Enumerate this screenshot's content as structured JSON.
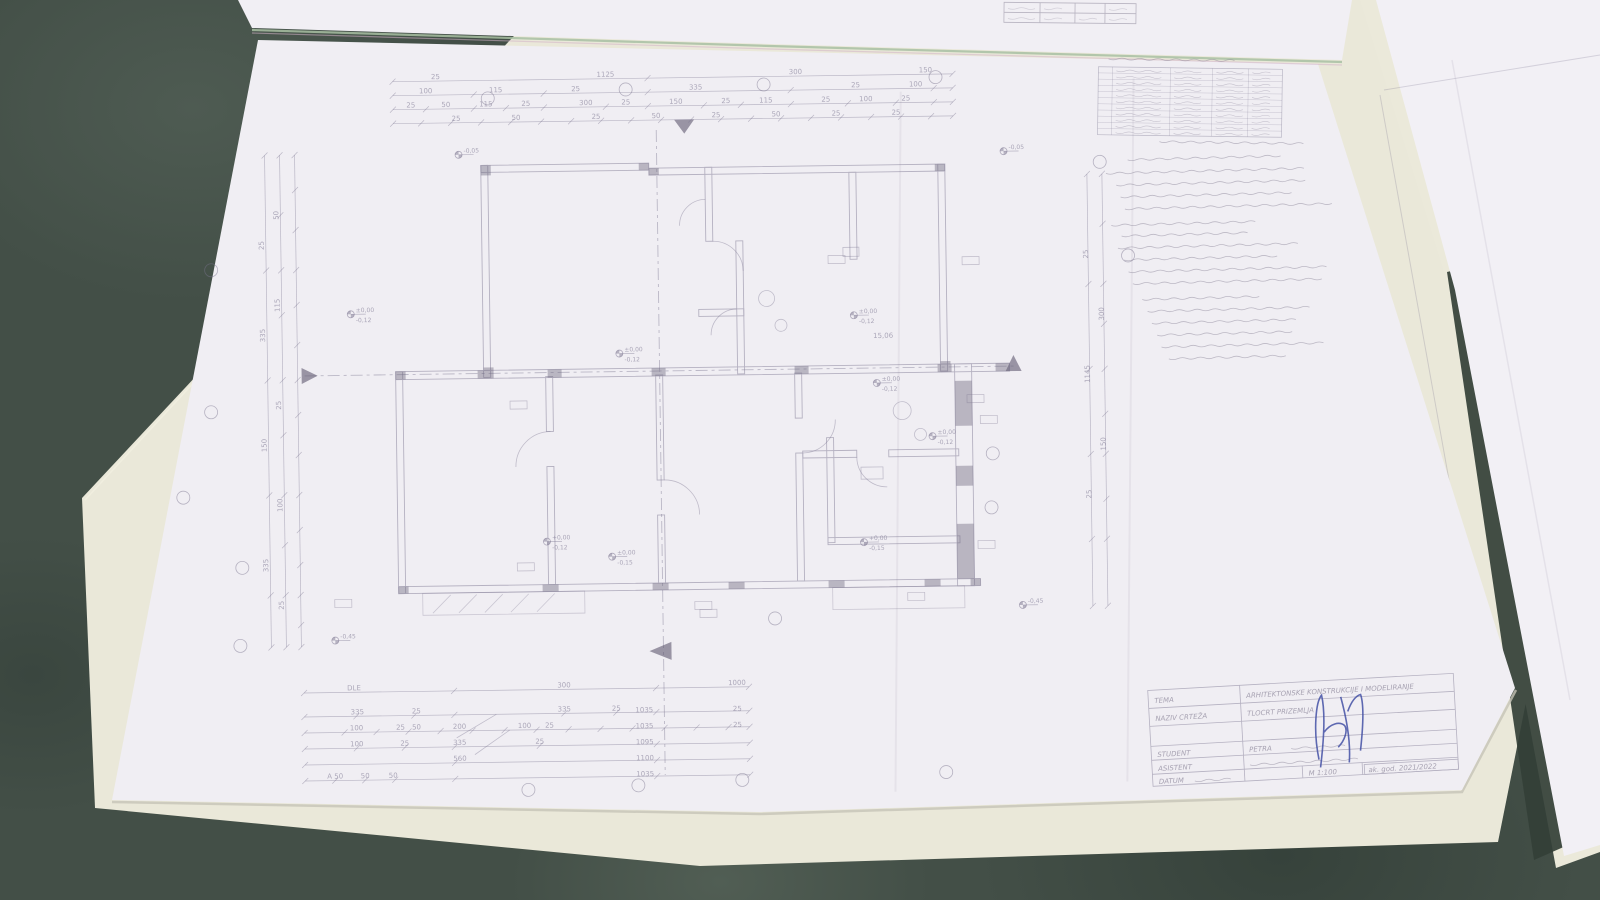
{
  "meta": {
    "description": "Photo of a hand-drawn pencil architectural floor plan sheet on a cream drawing board, dark green table, neighbouring sheets at top and right",
    "pencil_color": "#7b7590",
    "paper_color": "#f0eef3",
    "board_color": "#eae8d9",
    "table_color": "#434f47",
    "signature_color": "#4350a5"
  },
  "title_block": {
    "rows": [
      {
        "label": "TEMA",
        "value": "ARHITEKTONSKE KONSTRUKCIJE I MODELIRANJE"
      },
      {
        "label": "NAZIV CRTEŽA",
        "value": "TLOCRT PRIZEMLJA"
      },
      {
        "label": "STUDENT",
        "value": "PETRA"
      },
      {
        "label": "ASISTENT",
        "value": ""
      },
      {
        "label": "DATUM",
        "value": ""
      }
    ],
    "scale": "M 1:100",
    "year": "ak. god. 2021/2022"
  },
  "legend": {
    "x": 1098,
    "y": 68,
    "w": 184,
    "h": 68,
    "rows": 11,
    "cols": [
      14,
      72,
      114,
      150
    ]
  },
  "plan": {
    "chains": [
      {
        "o": "h",
        "p": 78,
        "a": 397,
        "b": 957,
        "t": [
          397,
          652,
          957
        ]
      },
      {
        "o": "h",
        "p": 92,
        "a": 397,
        "b": 957,
        "t": [
          397,
          478,
          548,
          652,
          795,
          938,
          957
        ]
      },
      {
        "o": "h",
        "p": 106,
        "a": 397,
        "b": 957,
        "t": [
          397,
          430,
          478,
          510,
          548,
          610,
          652,
          708,
          745,
          795,
          852,
          900,
          938,
          957
        ]
      },
      {
        "o": "h",
        "p": 120,
        "a": 397,
        "b": 957,
        "t": [
          397,
          425,
          455,
          485,
          515,
          545,
          575,
          605,
          635,
          665,
          695,
          725,
          755,
          785,
          815,
          845,
          875,
          905,
          935,
          957
        ]
      },
      {
        "o": "v",
        "p": 268,
        "a": 150,
        "b": 642,
        "t": [
          150,
          265,
          375,
          490,
          590,
          642
        ]
      },
      {
        "o": "v",
        "p": 283,
        "a": 150,
        "b": 642,
        "t": [
          150,
          210,
          265,
          310,
          375,
          430,
          490,
          540,
          590,
          642
        ]
      },
      {
        "o": "v",
        "p": 298,
        "a": 150,
        "b": 642,
        "t": [
          150,
          185,
          225,
          265,
          300,
          340,
          375,
          410,
          450,
          490,
          525,
          560,
          590,
          620,
          642
        ]
      },
      {
        "o": "v",
        "p": 1090,
        "a": 180,
        "b": 612,
        "t": [
          180,
          290,
          375,
          460,
          545,
          612
        ]
      },
      {
        "o": "v",
        "p": 1105,
        "a": 180,
        "b": 612,
        "t": [
          180,
          230,
          290,
          330,
          375,
          420,
          460,
          505,
          545,
          612
        ]
      },
      {
        "o": "h",
        "p": 688,
        "a": 300,
        "b": 745,
        "t": [
          300,
          450,
          652,
          745
        ]
      },
      {
        "o": "h",
        "p": 712,
        "a": 300,
        "b": 745,
        "t": [
          300,
          352,
          410,
          450,
          560,
          612,
          652,
          745
        ]
      },
      {
        "o": "h",
        "p": 728,
        "a": 300,
        "b": 745,
        "t": [
          300,
          340,
          372,
          404,
          436,
          468,
          500,
          532,
          564,
          596,
          628,
          660,
          692,
          724,
          745
        ]
      },
      {
        "o": "h",
        "p": 744,
        "a": 300,
        "b": 745,
        "t": [
          300,
          352,
          400,
          450,
          535,
          652,
          745
        ]
      },
      {
        "o": "h",
        "p": 760,
        "a": 300,
        "b": 745,
        "t": [
          300,
          450,
          652,
          745
        ]
      },
      {
        "o": "h",
        "p": 776,
        "a": 300,
        "b": 745,
        "t": [
          300,
          330,
          360,
          390,
          450,
          652,
          745
        ]
      }
    ],
    "labels": [
      [
        440,
        76,
        "25"
      ],
      [
        610,
        76,
        "1125"
      ],
      [
        800,
        76,
        "300"
      ],
      [
        930,
        76,
        "150"
      ],
      [
        430,
        90,
        "100"
      ],
      [
        500,
        90,
        "115"
      ],
      [
        580,
        90,
        "25"
      ],
      [
        700,
        90,
        "335"
      ],
      [
        860,
        90,
        "25"
      ],
      [
        920,
        90,
        "100"
      ],
      [
        415,
        104,
        "25"
      ],
      [
        450,
        104,
        "50"
      ],
      [
        490,
        104,
        "115"
      ],
      [
        530,
        104,
        "25"
      ],
      [
        590,
        104,
        "300"
      ],
      [
        630,
        104,
        "25"
      ],
      [
        680,
        104,
        "150"
      ],
      [
        730,
        104,
        "25"
      ],
      [
        770,
        104,
        "115"
      ],
      [
        830,
        104,
        "25"
      ],
      [
        870,
        104,
        "100"
      ],
      [
        910,
        104,
        "25"
      ],
      [
        460,
        118,
        "25"
      ],
      [
        520,
        118,
        "50"
      ],
      [
        600,
        118,
        "25"
      ],
      [
        660,
        118,
        "50"
      ],
      [
        720,
        118,
        "25"
      ],
      [
        780,
        118,
        "50"
      ],
      [
        840,
        118,
        "25"
      ],
      [
        900,
        118,
        "25"
      ],
      [
        266,
        240,
        "25",
        -90
      ],
      [
        266,
        330,
        "335",
        -90
      ],
      [
        266,
        440,
        "150",
        -90
      ],
      [
        266,
        560,
        "335",
        -90
      ],
      [
        281,
        210,
        "50",
        -90
      ],
      [
        281,
        300,
        "115",
        -90
      ],
      [
        281,
        400,
        "25",
        -90
      ],
      [
        281,
        500,
        "100",
        -90
      ],
      [
        281,
        600,
        "25",
        -90
      ],
      [
        1090,
        260,
        "25",
        -90
      ],
      [
        1090,
        380,
        "1145",
        -90
      ],
      [
        1090,
        500,
        "25",
        -90
      ],
      [
        1105,
        320,
        "300",
        -90
      ],
      [
        1105,
        450,
        "150",
        -90
      ],
      [
        350,
        686,
        "DLE"
      ],
      [
        560,
        686,
        "300"
      ],
      [
        733,
        686,
        "1000"
      ],
      [
        353,
        710,
        "335"
      ],
      [
        412,
        710,
        "25"
      ],
      [
        560,
        710,
        "335"
      ],
      [
        612,
        710,
        "25"
      ],
      [
        640,
        712,
        "1035"
      ],
      [
        733,
        712,
        "25"
      ],
      [
        352,
        726,
        "100"
      ],
      [
        396,
        726,
        "25"
      ],
      [
        412,
        726,
        "50"
      ],
      [
        455,
        726,
        "200"
      ],
      [
        520,
        726,
        "100"
      ],
      [
        545,
        726,
        "25"
      ],
      [
        640,
        728,
        "1035"
      ],
      [
        733,
        728,
        "25"
      ],
      [
        352,
        742,
        "100"
      ],
      [
        400,
        742,
        "25"
      ],
      [
        455,
        742,
        "335"
      ],
      [
        535,
        742,
        "25"
      ],
      [
        640,
        744,
        "1095"
      ],
      [
        455,
        758,
        "560"
      ],
      [
        640,
        760,
        "1100"
      ],
      [
        330,
        774,
        "A 50"
      ],
      [
        360,
        774,
        "50"
      ],
      [
        388,
        774,
        "50"
      ],
      [
        640,
        776,
        "1035"
      ],
      [
        884,
        341,
        "15,06"
      ]
    ],
    "elevations": [
      [
        462,
        152,
        "-0,05",
        ""
      ],
      [
        352,
        310,
        "±0,00",
        "-0,12"
      ],
      [
        620,
        353,
        "±0,00",
        "-0,12"
      ],
      [
        545,
        540,
        "+0,00",
        "-0,12"
      ],
      [
        610,
        556,
        "±0,00",
        "-0,15"
      ],
      [
        855,
        318,
        "±0,00",
        "-0,12"
      ],
      [
        877,
        386,
        "±0,00",
        "-0,12"
      ],
      [
        932,
        440,
        "±0,00",
        "-0,12"
      ],
      [
        862,
        545,
        "+0,00",
        "-0,15"
      ],
      [
        1007,
        156,
        "-0,05",
        ""
      ],
      [
        332,
        636,
        "-0,45",
        ""
      ],
      [
        1020,
        610,
        "-0,45",
        ""
      ]
    ],
    "bubbles": [
      [
        492,
        96
      ],
      [
        630,
        89
      ],
      [
        768,
        86
      ],
      [
        940,
        81
      ],
      [
        213,
        264
      ],
      [
        211,
        406
      ],
      [
        182,
        491
      ],
      [
        240,
        562
      ],
      [
        237,
        640
      ],
      [
        523,
        788
      ],
      [
        633,
        785
      ],
      [
        737,
        781
      ],
      [
        941,
        776
      ],
      [
        992,
        458
      ],
      [
        990,
        512
      ],
      [
        772,
        620
      ],
      [
        1103,
        168
      ],
      [
        1130,
        262
      ]
    ],
    "tags": [
      [
        518,
        403
      ],
      [
        340,
        599
      ],
      [
        523,
        565
      ],
      [
        700,
        606
      ],
      [
        913,
        600
      ],
      [
        975,
        403
      ],
      [
        838,
        262
      ],
      [
        972,
        265
      ],
      [
        988,
        424
      ],
      [
        984,
        549
      ],
      [
        705,
        614
      ]
    ]
  },
  "scribbles": [
    {
      "g": "tsheet",
      "x": 1008,
      "y": 9,
      "w": 28
    },
    {
      "g": "tsheet",
      "x": 1008,
      "y": 19,
      "w": 28
    },
    {
      "g": "tsheet",
      "x": 1044,
      "y": 9,
      "w": 26
    },
    {
      "g": "tsheet",
      "x": 1044,
      "y": 19,
      "w": 26
    },
    {
      "g": "tsheet",
      "x": 1079,
      "y": 19,
      "w": 22
    },
    {
      "g": "tsheet",
      "x": 1109,
      "y": 9,
      "w": 22
    },
    {
      "g": "tsheet",
      "x": 1109,
      "y": 19,
      "w": 22
    },
    {
      "g": "legend",
      "x": 1108,
      "y": 60,
      "w": 132
    },
    {
      "g": "legend",
      "x": 1160,
      "y": 142,
      "w": 148
    },
    {
      "g": "notes",
      "x": 1130,
      "y": 158,
      "w": 155
    },
    {
      "g": "notes",
      "x": 1108,
      "y": 171,
      "w": 205
    },
    {
      "g": "notes",
      "x": 1118,
      "y": 183,
      "w": 195
    },
    {
      "g": "notes",
      "x": 1122,
      "y": 195,
      "w": 175
    },
    {
      "g": "notes",
      "x": 1126,
      "y": 207,
      "w": 208
    },
    {
      "g": "notes",
      "x": 1112,
      "y": 223,
      "w": 152
    },
    {
      "g": "notes",
      "x": 1122,
      "y": 234,
      "w": 132
    },
    {
      "g": "notes",
      "x": 1118,
      "y": 246,
      "w": 182
    },
    {
      "g": "notes",
      "x": 1124,
      "y": 258,
      "w": 155
    },
    {
      "g": "notes",
      "x": 1128,
      "y": 270,
      "w": 200
    },
    {
      "g": "notes",
      "x": 1132,
      "y": 282,
      "w": 195
    },
    {
      "g": "notes",
      "x": 1141,
      "y": 298,
      "w": 118
    },
    {
      "g": "notes",
      "x": 1146,
      "y": 310,
      "w": 168
    },
    {
      "g": "notes",
      "x": 1150,
      "y": 322,
      "w": 148
    },
    {
      "g": "notes",
      "x": 1155,
      "y": 334,
      "w": 138
    },
    {
      "g": "notes",
      "x": 1159,
      "y": 346,
      "w": 168
    },
    {
      "g": "notes",
      "x": 1166,
      "y": 358,
      "w": 120
    },
    {
      "g": "tblock",
      "x": 1290,
      "y": 748,
      "w": 58
    },
    {
      "g": "tblock",
      "x": 1248,
      "y": 762,
      "w": 108
    },
    {
      "g": "tblock",
      "x": 1192,
      "y": 775,
      "w": 40
    }
  ]
}
